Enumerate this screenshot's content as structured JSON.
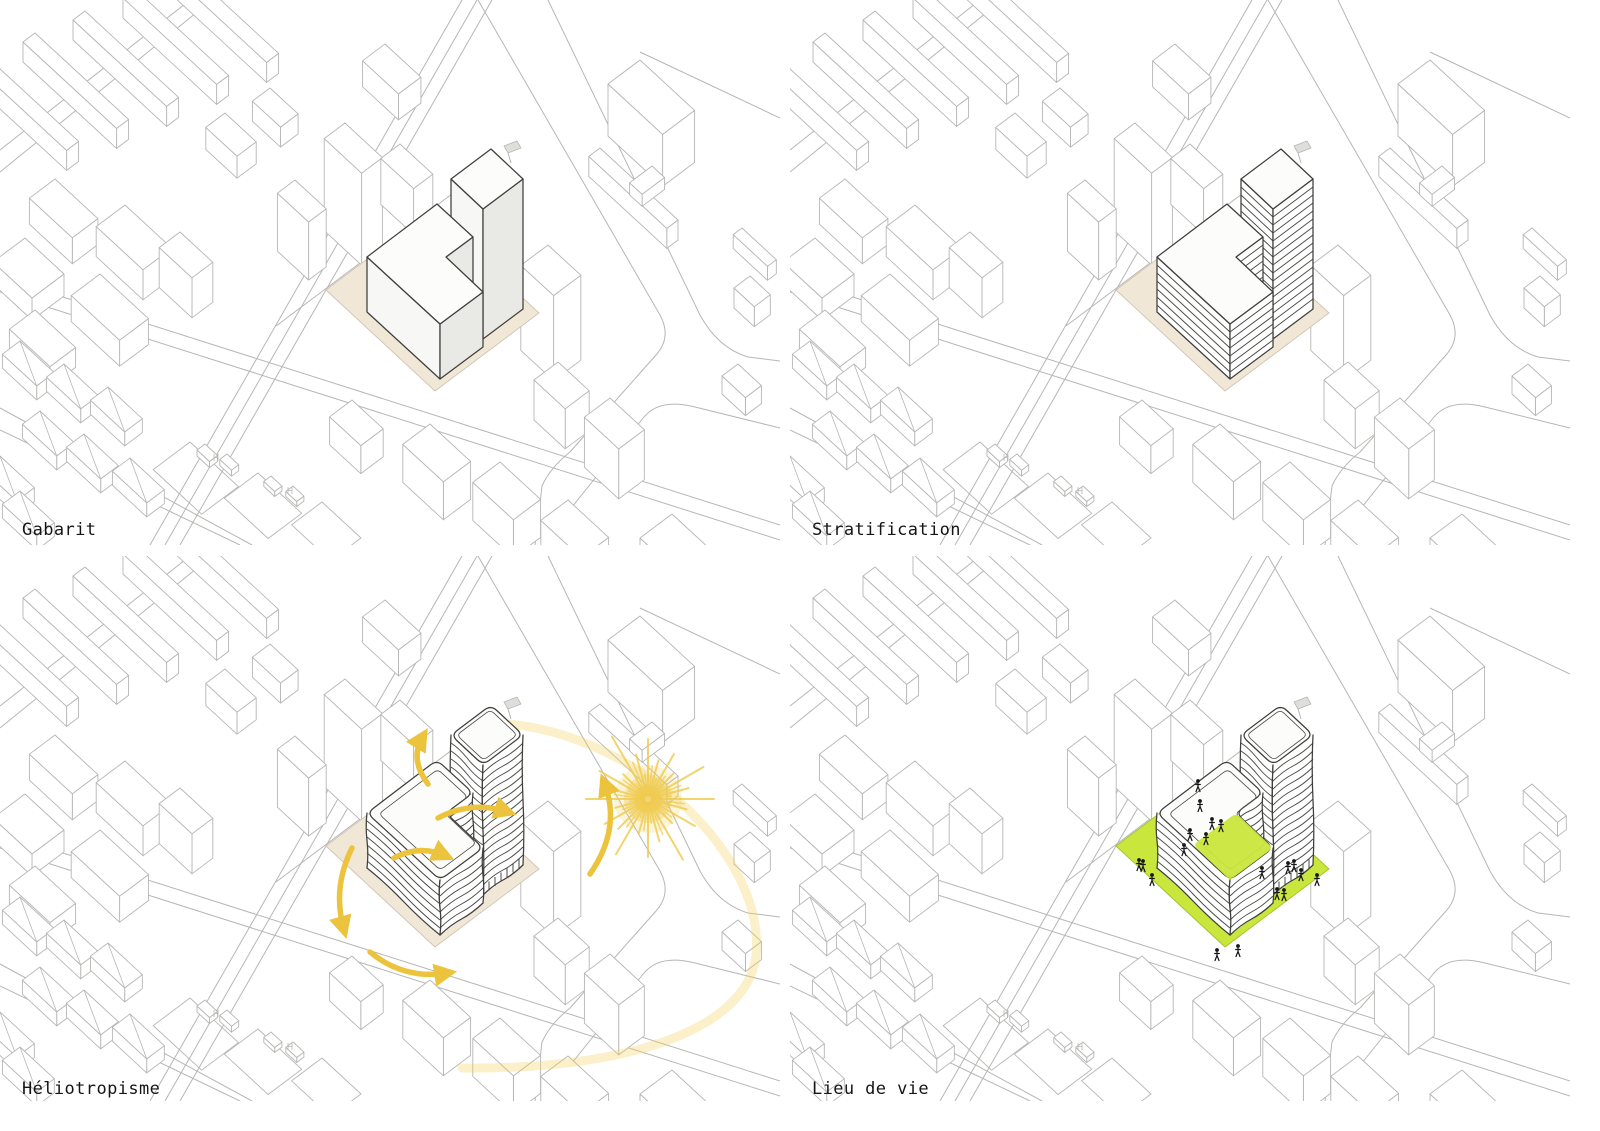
{
  "page": {
    "background": "#ffffff"
  },
  "panels": [
    {
      "id": "gabarit",
      "label": "Gabarit",
      "type": "solid-massing"
    },
    {
      "id": "stratification",
      "label": "Stratification",
      "type": "stratified-massing"
    },
    {
      "id": "heliotropisme",
      "label": "Héliotropisme",
      "type": "wavy-massing-sun"
    },
    {
      "id": "lieu-de-vie",
      "label": "Lieu de vie",
      "type": "wavy-massing-life"
    }
  ],
  "colors": {
    "background": "#ffffff",
    "context_line": "#b6b6b4",
    "outline": "#3e3e3c",
    "floor_line": "#4a4a47",
    "site_ground": "#f1e7d7",
    "ground_edge": "#cfc4b2",
    "face_top": "#fcfcfb",
    "face_left": "#f7f7f5",
    "face_right": "#e9e9e6",
    "sun": "#efcb4f",
    "arrow": "#ecc33c",
    "sun_arc": "#f2d056",
    "green": "#c9e63c",
    "green_edge": "#a5bf2e",
    "people": "#161616",
    "label_text": "#151515"
  }
}
